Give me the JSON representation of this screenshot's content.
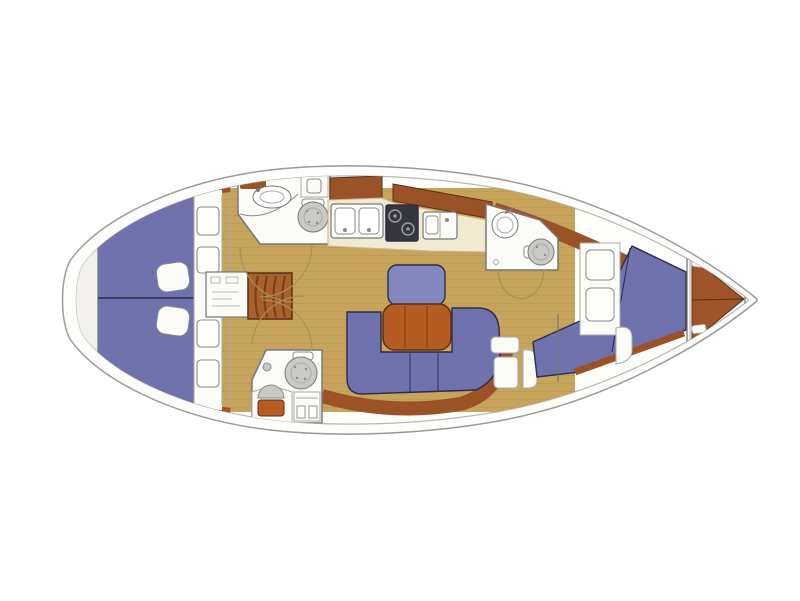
{
  "diagram": {
    "kind": "boat-floor-plan",
    "view": "top-down",
    "bow_direction": "right",
    "features": [
      "hull",
      "stern-swim-platform",
      "aft-berth-port",
      "aft-berth-starboard",
      "berth-pillows",
      "aft-storage-hatches",
      "engine-compartment",
      "companionway-steps",
      "aft-head-port",
      "aft-head-starboard",
      "toilet",
      "sink",
      "vanity",
      "galley-lockers",
      "galley-twin-sinks",
      "galley-stove",
      "galley-sink",
      "saloon-u-settee",
      "saloon-table",
      "saloon-bench",
      "nav-lockers",
      "dressing-seat",
      "forward-head",
      "forward-head-door-arcs",
      "forward-cabin-v-berth",
      "forward-cabin-seat",
      "forward-cabin-lockers",
      "collision-bulkhead",
      "anchor-locker",
      "bow-tip"
    ]
  },
  "colors": {
    "page_bg": "#ffffff",
    "hull_fill": "#fdfdfb",
    "hull_outline": "#9a9a98",
    "deck_line": "#b9b9b4",
    "platform": "#f1f1ea",
    "platform_line": "#d8d8d2",
    "floor_wood": "#c6a45c",
    "floor_grain": "#8a6a30",
    "cushion": "#6f72ac",
    "cushion_light": "#8487bd",
    "cushion_border": "#2c2c4a",
    "wood_trim": "#9c5227",
    "wood_trim_dark": "#5c3012",
    "table_wood": "#b45c22",
    "table_seam": "#7a3a12",
    "counter": "#f1e9d2",
    "counter_edge": "#c9b98a",
    "stove": "#35363f",
    "stove_ring": "#9a9aa2",
    "fixture_white": "#fbfbf8",
    "fixture_line": "#8a8a88",
    "toilet_gray": "#c9c9c6",
    "speckle": "#8f8f8c",
    "wall_line": "#77777a",
    "light_line": "#aaaaa8",
    "door_arc": "#a98f55",
    "steps": "#a8612e",
    "step_line": "#7c3f16",
    "anchor_locker": "#a0542a",
    "white": "#ffffff"
  }
}
